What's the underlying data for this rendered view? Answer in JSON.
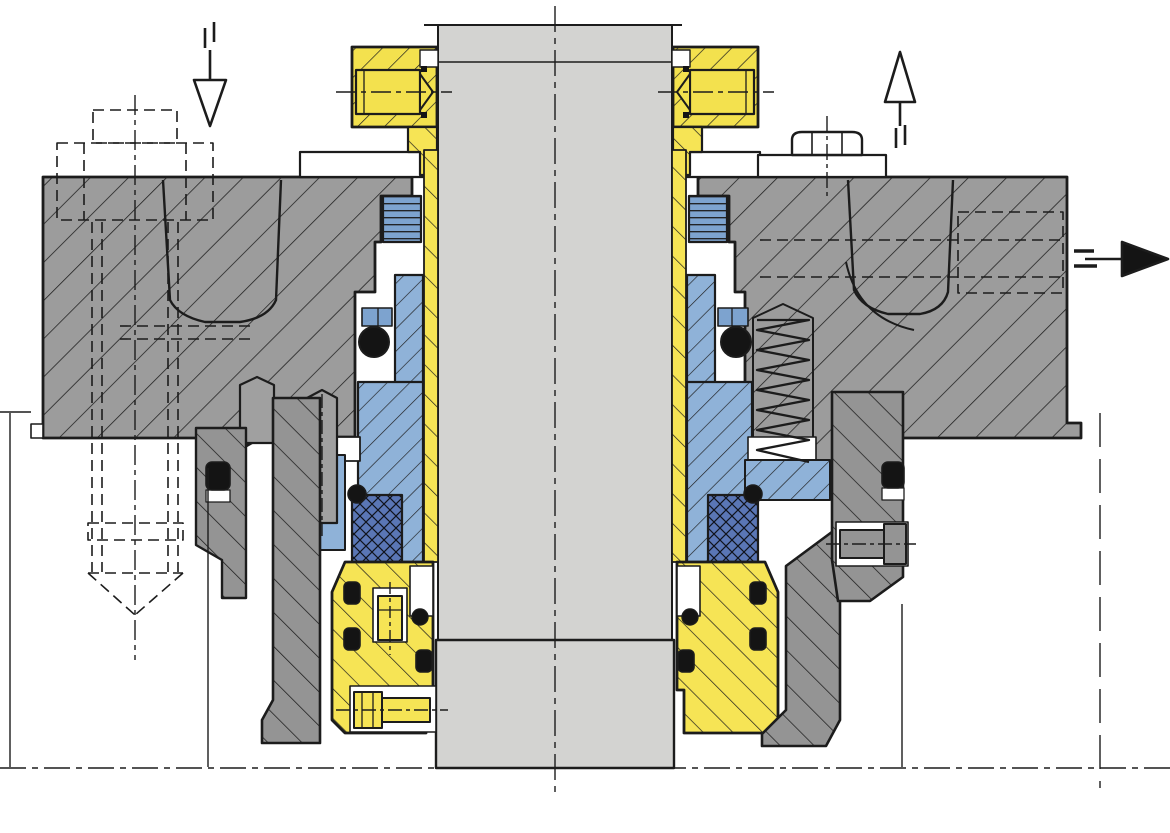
{
  "title": "mechanical-seal-cross-section-drawing",
  "colors": {
    "outline": "#1c1c1c",
    "housing": "#9c9c9c",
    "clamp": "#949494",
    "shaft": "#d3d3d1",
    "stud_gray": "#a0a0a0",
    "collar_yellow": "#f3e14e",
    "sleeve_yellow": "#f3e14e",
    "gland_yellow": "#f6e455",
    "orange": "#ffc01e",
    "seal_blue": "#8fb2d8",
    "thread_blue": "#7da3cf",
    "packing_navy": "#5a76b5",
    "black": "#141414",
    "white": "#ffffff"
  },
  "arrows": {
    "top_left": "flow-in-down",
    "top_right": "flow-out-up",
    "right": "drain-right"
  },
  "components": [
    "stuffing-box-housing",
    "pump-shaft",
    "shaft-sleeve",
    "drive-collar",
    "set-screw",
    "threaded-plug",
    "seal-ring",
    "o-ring",
    "packing-wedge",
    "thrust-ring",
    "gland-plate",
    "coil-spring",
    "gland-stud",
    "hex-bolt",
    "clamp-bracket",
    "hidden-anchor-bolt",
    "flush-port"
  ]
}
